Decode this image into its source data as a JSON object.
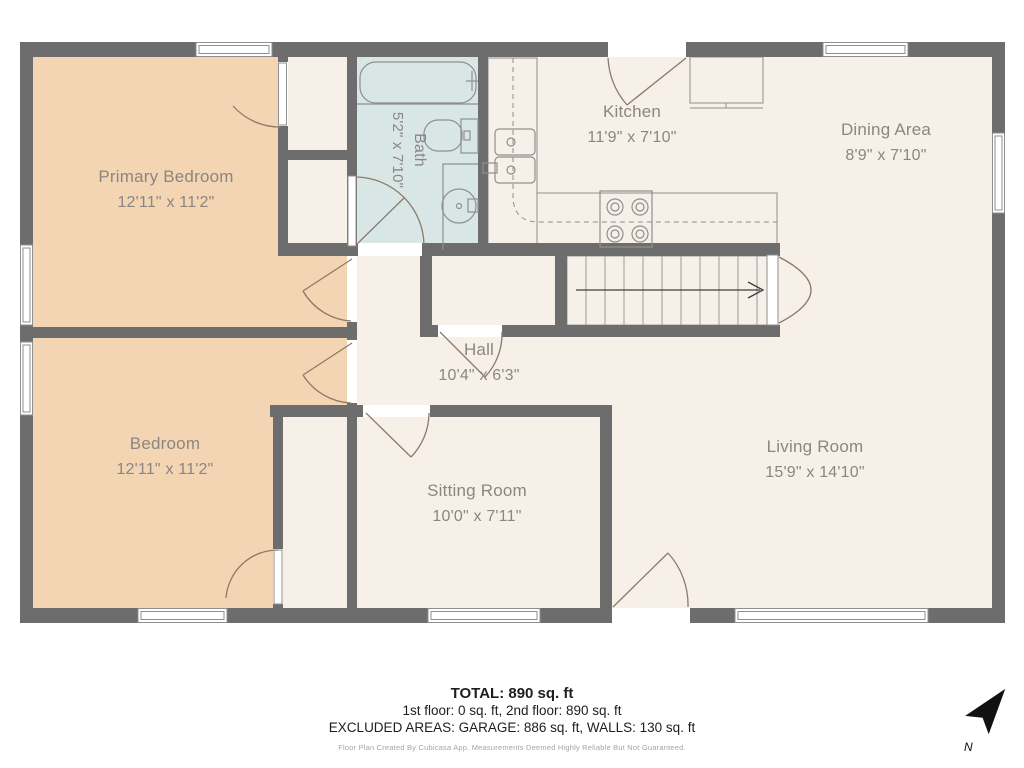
{
  "colors": {
    "wall": "#6d6d6d",
    "floor": "#f6f0e8",
    "bedroom_fill": "#f3d4b3",
    "bath_fill": "#d8e7e5",
    "door": "#8c7a69",
    "fixture": "#8f8f8f",
    "tread": "#9b9b9b",
    "arrow": "#3f3f3f",
    "label": "#8b8680",
    "compass_fill": "#111111"
  },
  "rooms": {
    "primary_bedroom": {
      "name": "Primary Bedroom",
      "dims": "12'11\" x 11'2\""
    },
    "bedroom": {
      "name": "Bedroom",
      "dims": "12'11\" x 11'2\""
    },
    "bath": {
      "name": "Bath",
      "dims": "5'2\" x 7'10\""
    },
    "kitchen": {
      "name": "Kitchen",
      "dims": "11'9\" x 7'10\""
    },
    "dining_area": {
      "name": "Dining Area",
      "dims": "8'9\" x 7'10\""
    },
    "hall": {
      "name": "Hall",
      "dims": "10'4\" x 6'3\""
    },
    "sitting_room": {
      "name": "Sitting Room",
      "dims": "10'0\" x 7'11\""
    },
    "living_room": {
      "name": "Living Room",
      "dims": "15'9\" x 14'10\""
    }
  },
  "footer": {
    "total": "TOTAL: 890 sq. ft",
    "floors": "1st floor: 0 sq. ft, 2nd floor: 890 sq. ft",
    "excluded": "EXCLUDED AREAS: GARAGE: 886 sq. ft, WALLS: 130 sq. ft",
    "disclaimer": "Floor Plan Created By Cubicasa App. Measurements Deemed Highly Reliable But Not Guaranteed."
  },
  "compass": {
    "north_label": "N"
  }
}
